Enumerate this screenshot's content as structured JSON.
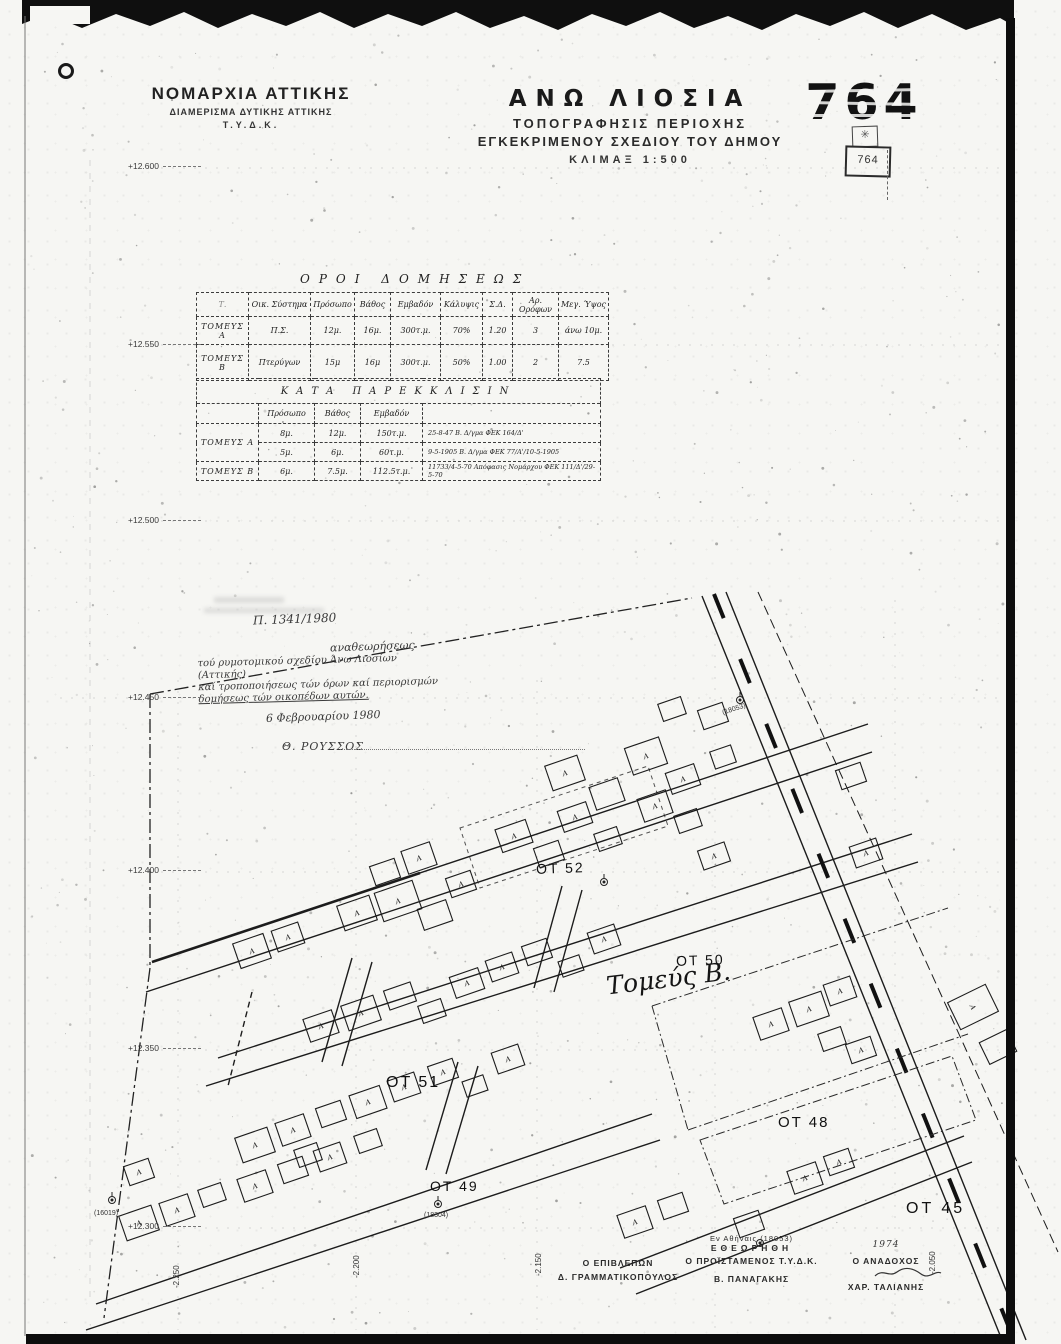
{
  "header": {
    "agency_line1": "ΝΟΜΑΡΧΙΑ ΑΤΤΙΚΗΣ",
    "agency_line2": "ΔΙΑΜΕΡΙΣΜΑ ΔΥΤΙΚΗΣ ΑΤΤΙΚΗΣ",
    "agency_line3": "Τ.Υ.Δ.Κ.",
    "title": "ΑΝΩ ΛΙΟΣΙΑ",
    "subtitle1": "ΤΟΠΟΓΡΑΦΗΣΙΣ ΠΕΡΙΟΧΗΣ",
    "subtitle2": "ΕΓΚΕΚΡΙΜΕΝΟΥ ΣΧΕΔΙΟΥ ΤΟΥ ΔΗΜΟΥ",
    "scale": "ΚΛΙΜΑΞ 1:500",
    "sheet_number": "764",
    "stamp_number": "764",
    "stamp_emblem": "✳"
  },
  "building_terms": {
    "title": "ΟΡΟΙ ΔΟΜΗΣΕΩΣ",
    "columns": [
      "Τ.",
      "Οικ. Σύστημα",
      "Πρόσωπο",
      "Βάθος",
      "Εμβαδόν",
      "Κάλυψις",
      "Σ.Δ.",
      "Αρ. Ορόφων",
      "Μεγ. Ύψος"
    ],
    "rows": [
      {
        "label": "ΤΟΜΕΥΣ Α",
        "cells": [
          "Π.Σ.",
          "12μ.",
          "16μ.",
          "300τ.μ.",
          "70%",
          "1.20",
          "3",
          "άνω 10μ."
        ]
      },
      {
        "label": "ΤΟΜΕΥΣ Β",
        "cells": [
          "Πτερύγων",
          "15μ",
          "16μ",
          "300τ.μ.",
          "50%",
          "1.00",
          "2",
          "7.5"
        ]
      }
    ]
  },
  "derogation": {
    "title": "ΚΑΤΑ ΠΑΡΕΚΚΛΙΣΙΝ",
    "columns": [
      "",
      "Πρόσωπο",
      "Βάθος",
      "Εμβαδόν",
      ""
    ],
    "rows": [
      {
        "label": "ΤΟΜΕΥΣ Α",
        "cells": [
          "8μ.",
          "12μ.",
          "150τ.μ.",
          "25-8-47 Β. Δ/γμα ΦΕΚ 164/Δ'"
        ]
      },
      {
        "label": "",
        "cells": [
          "5μ.",
          "6μ.",
          "60τ.μ.",
          "9-5-1905 Β. Δ/γμα ΦΕΚ 77/Α'/10-5-1905"
        ]
      },
      {
        "label": "ΤΟΜΕΥΣ Β",
        "cells": [
          "6μ.",
          "7.5μ.",
          "112.5τ.μ.",
          "11733/4-5-70 Απόφασις Νομάρχου ΦΕΚ 111/Δ'/29-5-70"
        ]
      }
    ]
  },
  "approval_note": {
    "reference": "Π. 1341/1980",
    "line1": "αναθεωρήσεως",
    "body1": "τού ρυμοτομικού σχεδίου Άνω Λιοσίων (Αττικής)",
    "body2": "καί τροποποιήσεως τών όρων καί περιορισμών",
    "body3": "δομήσεως τών οικοπέδων αυτών.",
    "date": "6 Φεβρουαρίου 1980",
    "signature": "Θ. ΡΟΥΣΣΟΣ"
  },
  "grid": {
    "elevations": [
      "+12.600",
      "+12.550",
      "+12.500",
      "+12.450",
      "+12.400",
      "+12.350",
      "+12.300"
    ],
    "bottom_coords": [
      "-2.250",
      "-2.200",
      "-2.150",
      "-2.050"
    ]
  },
  "map": {
    "blocks": [
      "ΟΤ 52",
      "ΟΤ 50",
      "ΟΤ 51",
      "ΟΤ 49",
      "ΟΤ 48",
      "ΟΤ 45"
    ],
    "sector_label": "Τομεύς Β.",
    "building_label": "Α",
    "benchmarks": [
      "(18053)",
      "(18304)",
      "(16019)"
    ]
  },
  "signatures": {
    "place": "Εν Αθήναις",
    "place_ref": "(18053)",
    "reviewed": "ΕΘΕΩΡΗΘΗ",
    "supervisor_title": "Ο ΕΠΙΒΛΕΠΩΝ",
    "supervisor_name": "Δ. ΓΡΑΜΜΑΤΙΚΟΠΟΥΛΟΣ",
    "head_title": "Ο ΠΡΟΪΣΤΑΜΕΝΟΣ Τ.Υ.Δ.Κ.",
    "head_name": "Β. ΠΑΝΑΓΑΚΗΣ",
    "contractor_title": "Ο ΑΝΑΔΟΧΟΣ",
    "contractor_name": "ΧΑΡ. ΤΑΛΙΑΝΗΣ",
    "year": "1974"
  }
}
